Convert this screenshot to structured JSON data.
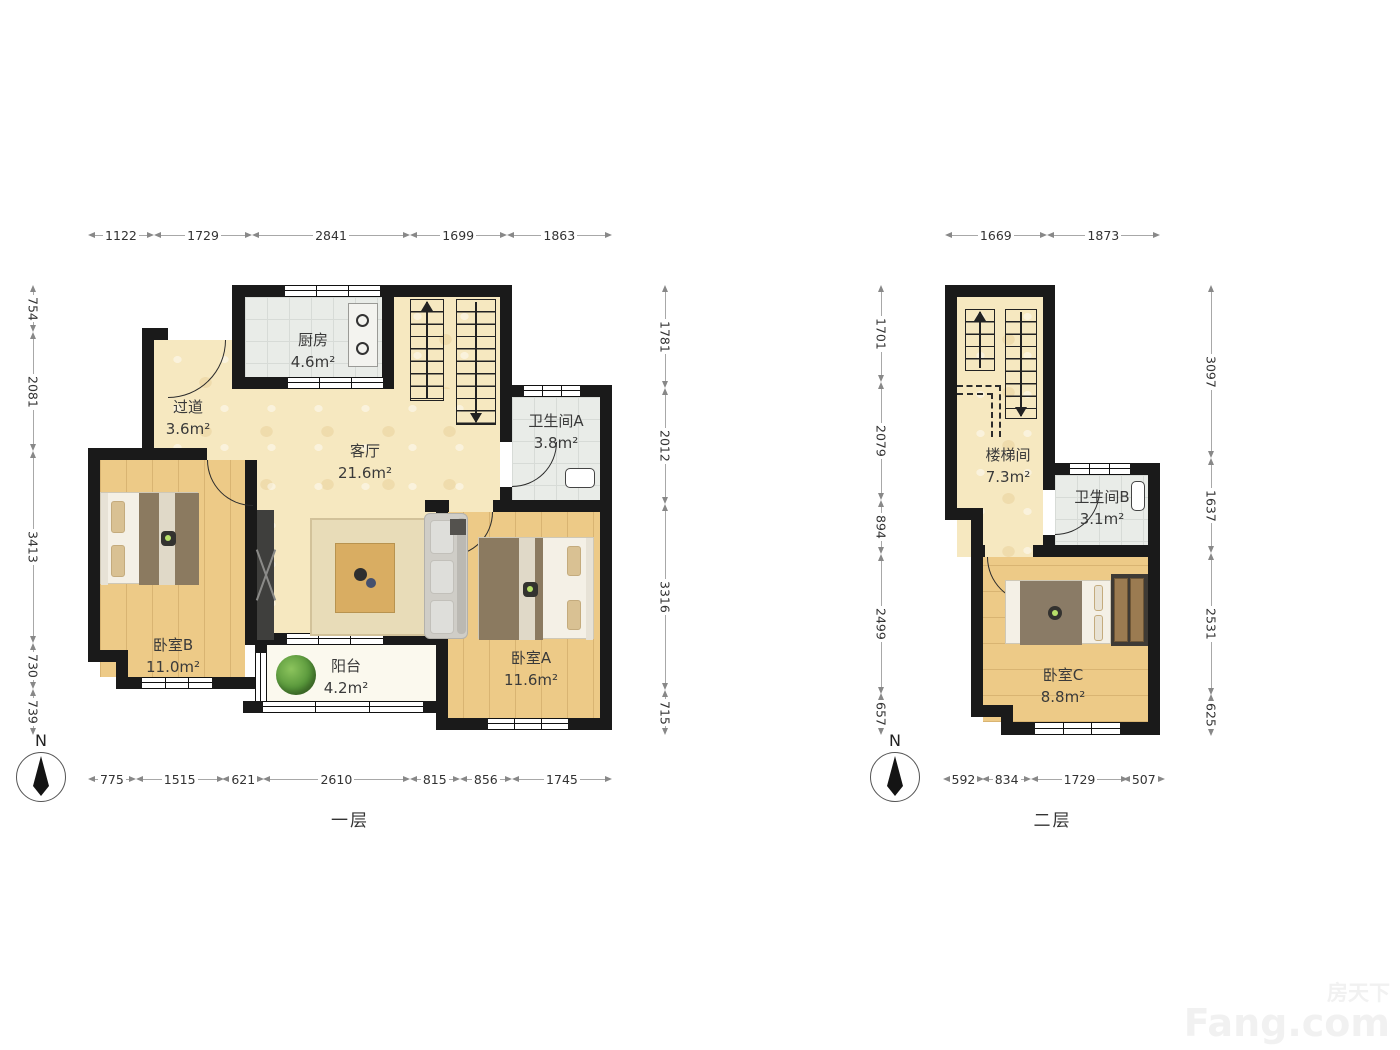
{
  "watermark": {
    "line1": "房天下",
    "line2": "Fang.com"
  },
  "palette": {
    "wall": "#1a1a1a",
    "floor_main": "#f6e8c0",
    "floor_wood": "#edca87",
    "floor_tile": "#e9ece8",
    "floor_balcony": "#fbf9ee"
  },
  "floor1": {
    "caption": "一层",
    "compass_label": "N",
    "dims_top": [
      "1122",
      "1729",
      "2841",
      "1699",
      "1863"
    ],
    "dims_bottom": [
      "775",
      "1515",
      "621",
      "2610",
      "815",
      "856",
      "1745"
    ],
    "dims_left": [
      "754",
      "2081",
      "3413",
      "730",
      "739"
    ],
    "dims_right": [
      "1781",
      "2012",
      "3316",
      "715"
    ],
    "rooms": [
      {
        "name": "厨房",
        "area": "4.6m²"
      },
      {
        "name": "过道",
        "area": "3.6m²"
      },
      {
        "name": "客厅",
        "area": "21.6m²"
      },
      {
        "name": "卫生间A",
        "area": "3.8m²"
      },
      {
        "name": "卧室B",
        "area": "11.0m²"
      },
      {
        "name": "阳台",
        "area": "4.2m²"
      },
      {
        "name": "卧室A",
        "area": "11.6m²"
      }
    ]
  },
  "floor2": {
    "caption": "二层",
    "compass_label": "N",
    "dims_top": [
      "1669",
      "1873"
    ],
    "dims_bottom": [
      "592",
      "834",
      "1729",
      "507"
    ],
    "dims_left": [
      "1701",
      "2079",
      "894",
      "2499",
      "657"
    ],
    "dims_right": [
      "3097",
      "1637",
      "2531",
      "625"
    ],
    "rooms": [
      {
        "name": "楼梯间",
        "area": "7.3m²"
      },
      {
        "name": "卫生间B",
        "area": "3.1m²"
      },
      {
        "name": "卧室C",
        "area": "8.8m²"
      }
    ]
  }
}
